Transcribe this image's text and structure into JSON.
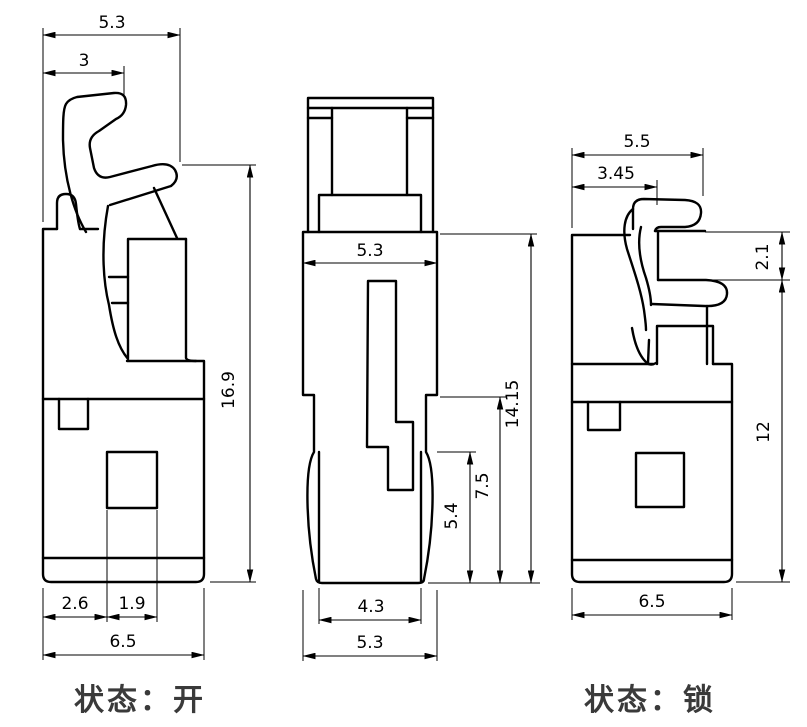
{
  "drawing": {
    "type": "technical-drawing",
    "subject": "connector latch shown in open and locked states",
    "background": "#ffffff",
    "line_color": "#000000",
    "label_color": "#3a3a3a"
  },
  "left_view": {
    "state_label": "状态：开",
    "dims": {
      "overall_width": "5.3",
      "latch_tip_width": "3",
      "overall_height": "16.9",
      "edge_to_window": "2.6",
      "window_width": "1.9",
      "body_width": "6.5"
    }
  },
  "front_view": {
    "dims": {
      "body_width": "5.3",
      "tip_width": "4.3",
      "bottom_width": "5.3",
      "wing_height": "5.4",
      "lower_height": "7.5",
      "overall_height": "14.15"
    }
  },
  "right_view": {
    "state_label": "状态：锁",
    "dims": {
      "overall_width": "5.5",
      "latch_width": "3.45",
      "hook_gap": "2.1",
      "body_height": "12",
      "body_width": "6.5"
    }
  }
}
